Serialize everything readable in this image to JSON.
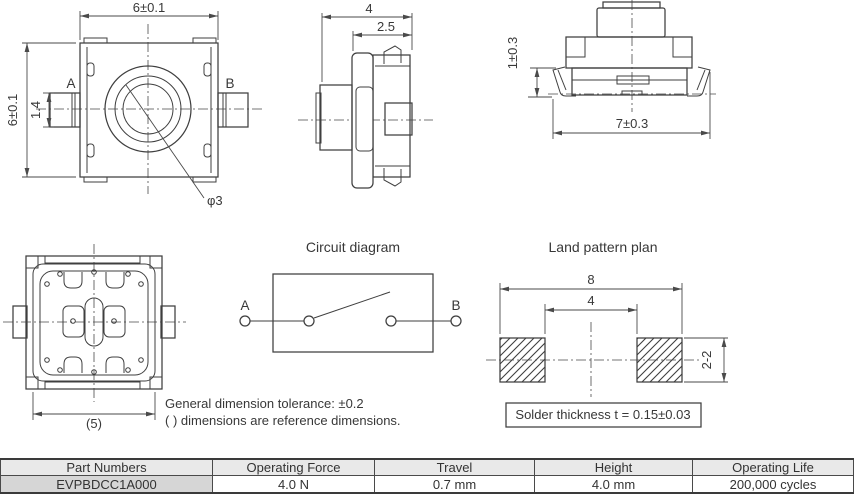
{
  "colors": {
    "line": "#3f3f3f",
    "text": "#383838",
    "table_header_bg": "#e9e9e9",
    "part_cell_bg": "#d6d6d6",
    "table_border": "#3a3a3a",
    "background": "#ffffff"
  },
  "top_view": {
    "width_dim": "6±0.1",
    "height_dim": "6±0.1",
    "tab_dim": "1.4",
    "terminal_a": "A",
    "terminal_b": "B",
    "button_dia": "φ3"
  },
  "side_view": {
    "width_dim": "4",
    "step_dim": "2.5"
  },
  "front_view": {
    "lead_dim": "1±0.3",
    "span_dim": "7±0.3"
  },
  "bottom_view": {
    "ref_dim": "(5)"
  },
  "circuit": {
    "title": "Circuit diagram",
    "terminal_a": "A",
    "terminal_b": "B"
  },
  "land_pattern": {
    "title": "Land pattern plan",
    "outer_dim": "8",
    "inner_dim": "4",
    "pad_dim": "2-2",
    "solder_note": "Solder thickness t = 0.15±0.03"
  },
  "notes": {
    "line1": "General dimension tolerance: ±0.2",
    "line2": "( ) dimensions are reference dimensions."
  },
  "table": {
    "headers": [
      "Part Numbers",
      "Operating Force",
      "Travel",
      "Height",
      "Operating Life"
    ],
    "rows": [
      [
        "EVPBDCC1A000",
        "4.0 N",
        "0.7 mm",
        "4.0 mm",
        "200,000 cycles"
      ]
    ]
  }
}
